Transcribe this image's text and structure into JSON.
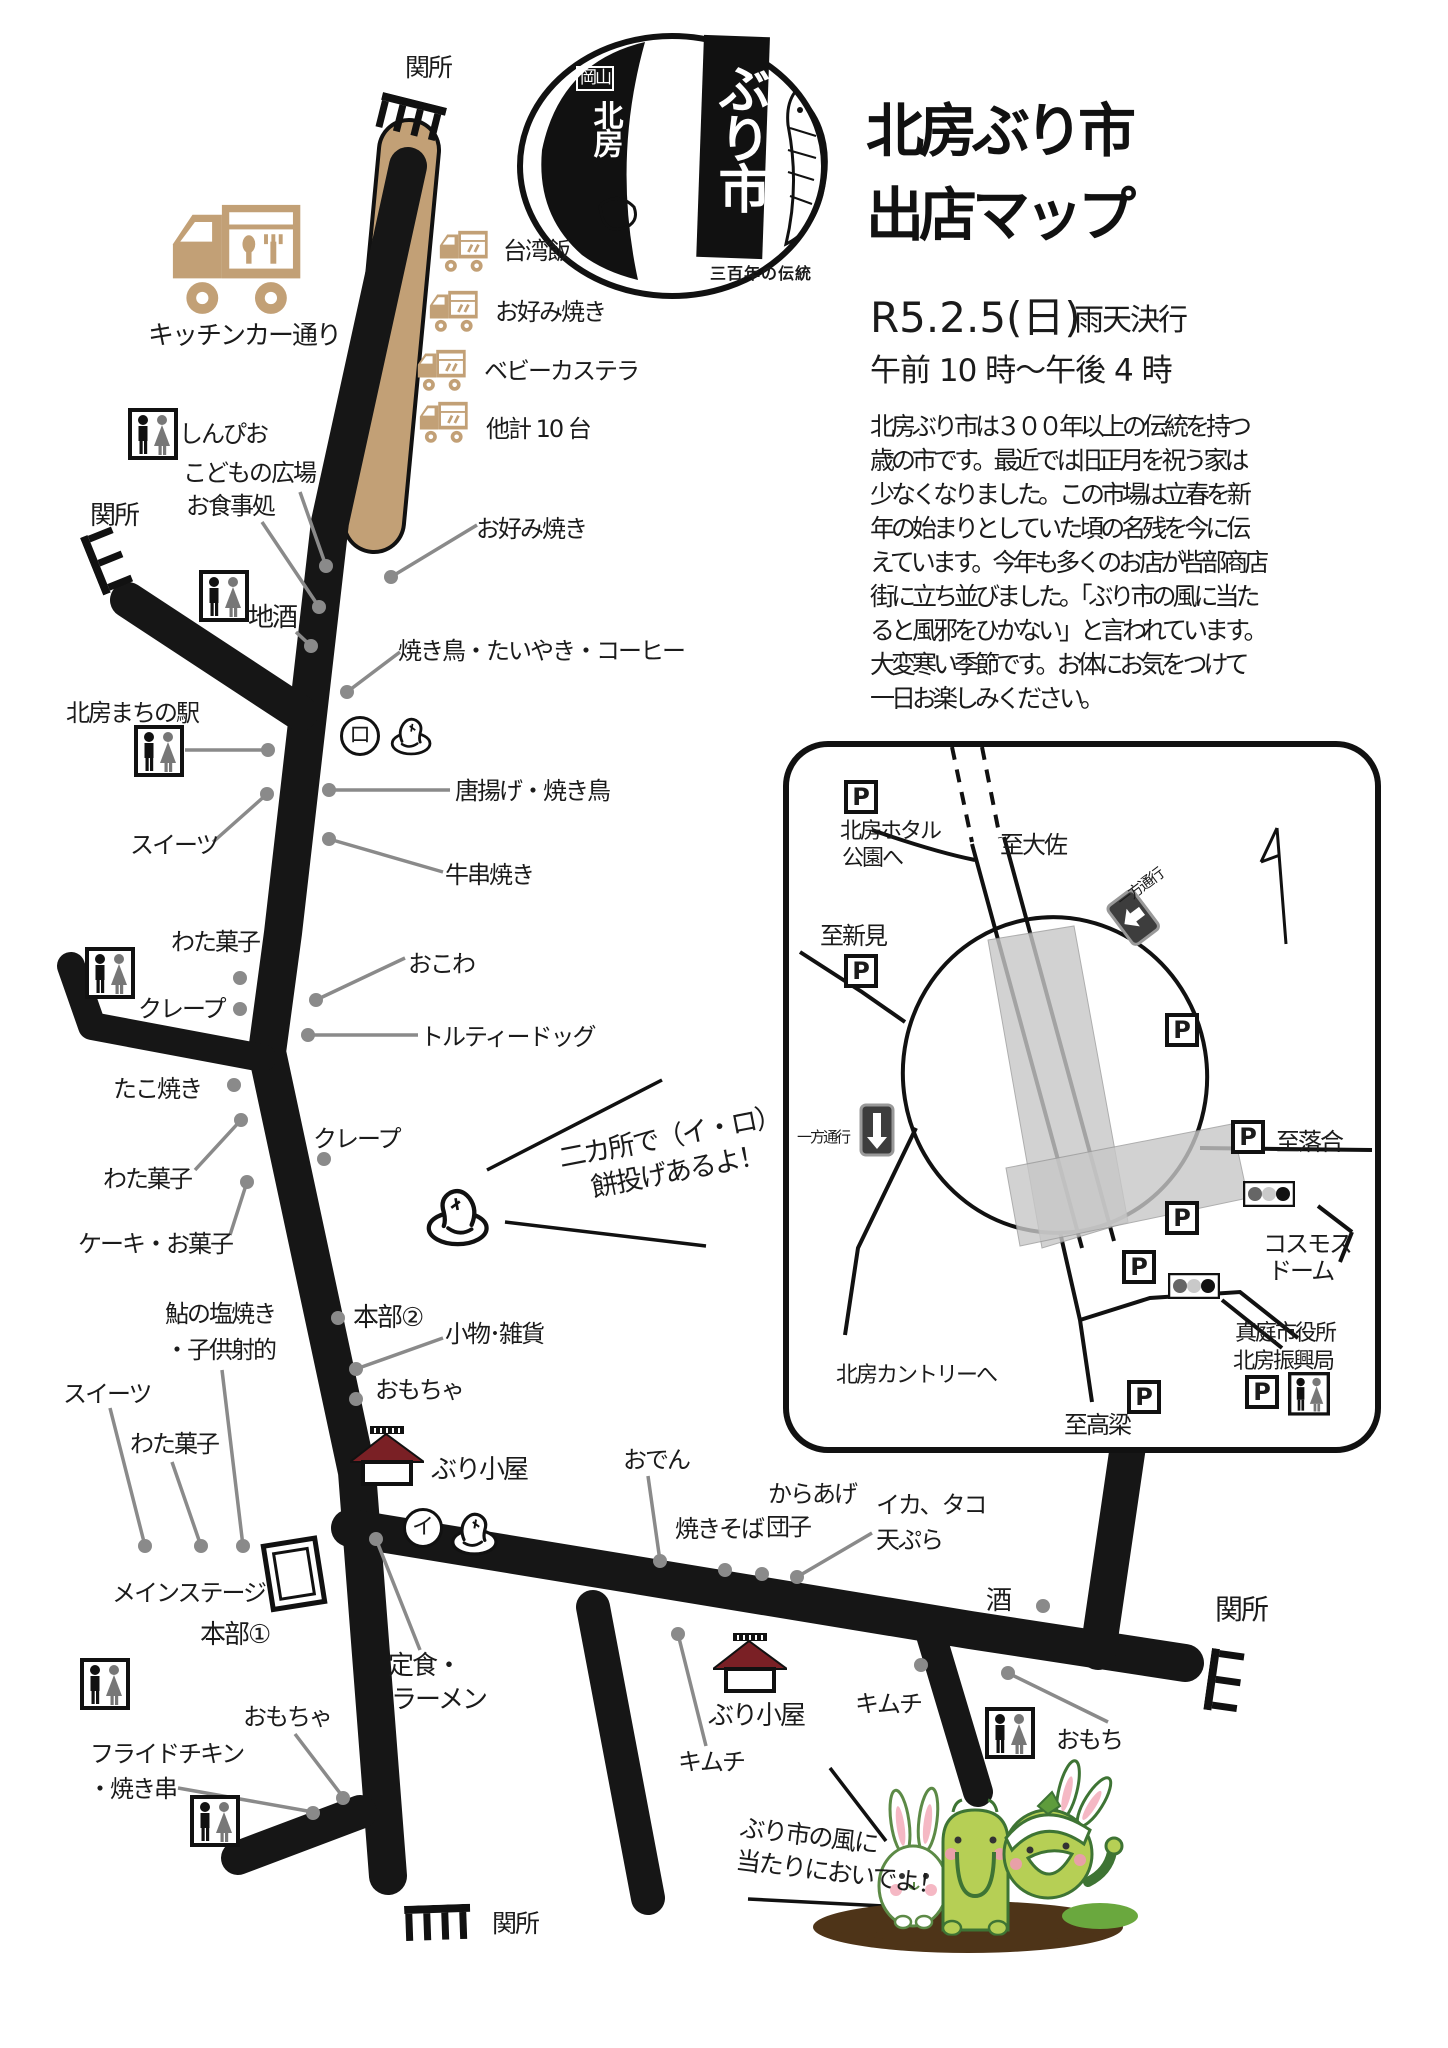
{
  "colors": {
    "road": "#161616",
    "kitchen_tan": "#c2a076",
    "leader": "#8a8a8a",
    "hut_roof": "#7a2025",
    "inset_gray": "#c8c8c8",
    "mascot_green": "#b6cf55"
  },
  "logo": {
    "pref": "岡山",
    "town": "北房",
    "market": "ぶり市",
    "tagline": "三百年の伝統"
  },
  "header": {
    "title_l1": "北房ぶり市",
    "title_l2": "出店マップ",
    "date": "R5.2.5(日)",
    "weather": "雨天決行",
    "hours": "午前 10 時～午後 4 時",
    "intro": "北房ぶり市は３００年以上の伝統を持つ歳の市です。最近では旧正月を祝う家は少なくなりました。この市場は立春を新年の始まりとしていた頃の名残を今に伝えています。今年も多くのお店が呰部商店街に立ち並びました。「ぶり市の風に当たると風邪をひかない」と言われています。大変寒い季節です。お体にお気をつけて一日お楽しみください。"
  },
  "checkpoint": "関所",
  "kitchen": {
    "street": "キッチンカー通り",
    "truck1": "台湾飯",
    "truck2": "お好み焼き",
    "truck3": "ベビーカステラ",
    "truck4": "他計 10 台"
  },
  "stalls": {
    "okonomiyaki": "お好み焼き",
    "yakitori_set": "焼き鳥・たいやき・コーヒー",
    "shinpio": "しんぴお",
    "kodomo": "こどもの広場",
    "shokuji": "お食事処",
    "jizake": "地酒",
    "machinoeki": "北房まちの駅",
    "karaage_yakitori": "唐揚げ・焼き鳥",
    "sweets1": "スイーツ",
    "gyukushi": "牛串焼き",
    "watagashi1": "わた菓子",
    "crepe1": "クレープ",
    "okowa": "おこわ",
    "tortilla": "トルティードッグ",
    "takoyaki": "たこ焼き",
    "crepe2": "クレープ",
    "watagashi2": "わた菓子",
    "cake": "ケーキ・お菓子",
    "ayu1": "鮎の塩焼き",
    "ayu2": "・子供射的",
    "sweets2": "スイーツ",
    "watagashi3": "わた菓子",
    "stage": "メインステージ",
    "honbu1": "本部①",
    "honbu2": "本部②",
    "komono": "小物･雑貨",
    "omocha1": "おもちゃ",
    "burigoya1": "ぶり小屋",
    "teishoku1": "定食・",
    "teishoku2": "ラーメン",
    "omocha2": "おもちゃ",
    "fried1": "フライドチキン",
    "fried2": "・焼き串",
    "oden": "おでん",
    "yakisoba": "焼きそば",
    "dango": "団子",
    "karaage": "からあげ",
    "ika1": "イカ、タコ",
    "ika2": "天ぷら",
    "sake": "酒",
    "kimchi1": "キムチ",
    "burigoya2": "ぶり小屋",
    "kimchi2": "キムチ",
    "omochi": "おもち"
  },
  "marks": {
    "i": "イ",
    "ro": "ロ"
  },
  "notes": {
    "mochi1": "二カ所で（イ・ロ）",
    "mochi2": "餅投げあるよ！",
    "come1": "ぶり市の風に",
    "come2": "当たりにおいでよ！"
  },
  "inset": {
    "parking": "P",
    "hotaru1": "北房ホタル",
    "hotaru2": "公園へ",
    "daisa": "至大佐",
    "niimi": "至新見",
    "oneway": "一方通行",
    "ochiai": "至落合",
    "cosmos1": "コスモス",
    "cosmos2": "ドーム",
    "maniwa1": "真庭市役所",
    "maniwa2": "北房振興局",
    "country": "北房カントリーへ",
    "takahashi": "至高梁"
  }
}
